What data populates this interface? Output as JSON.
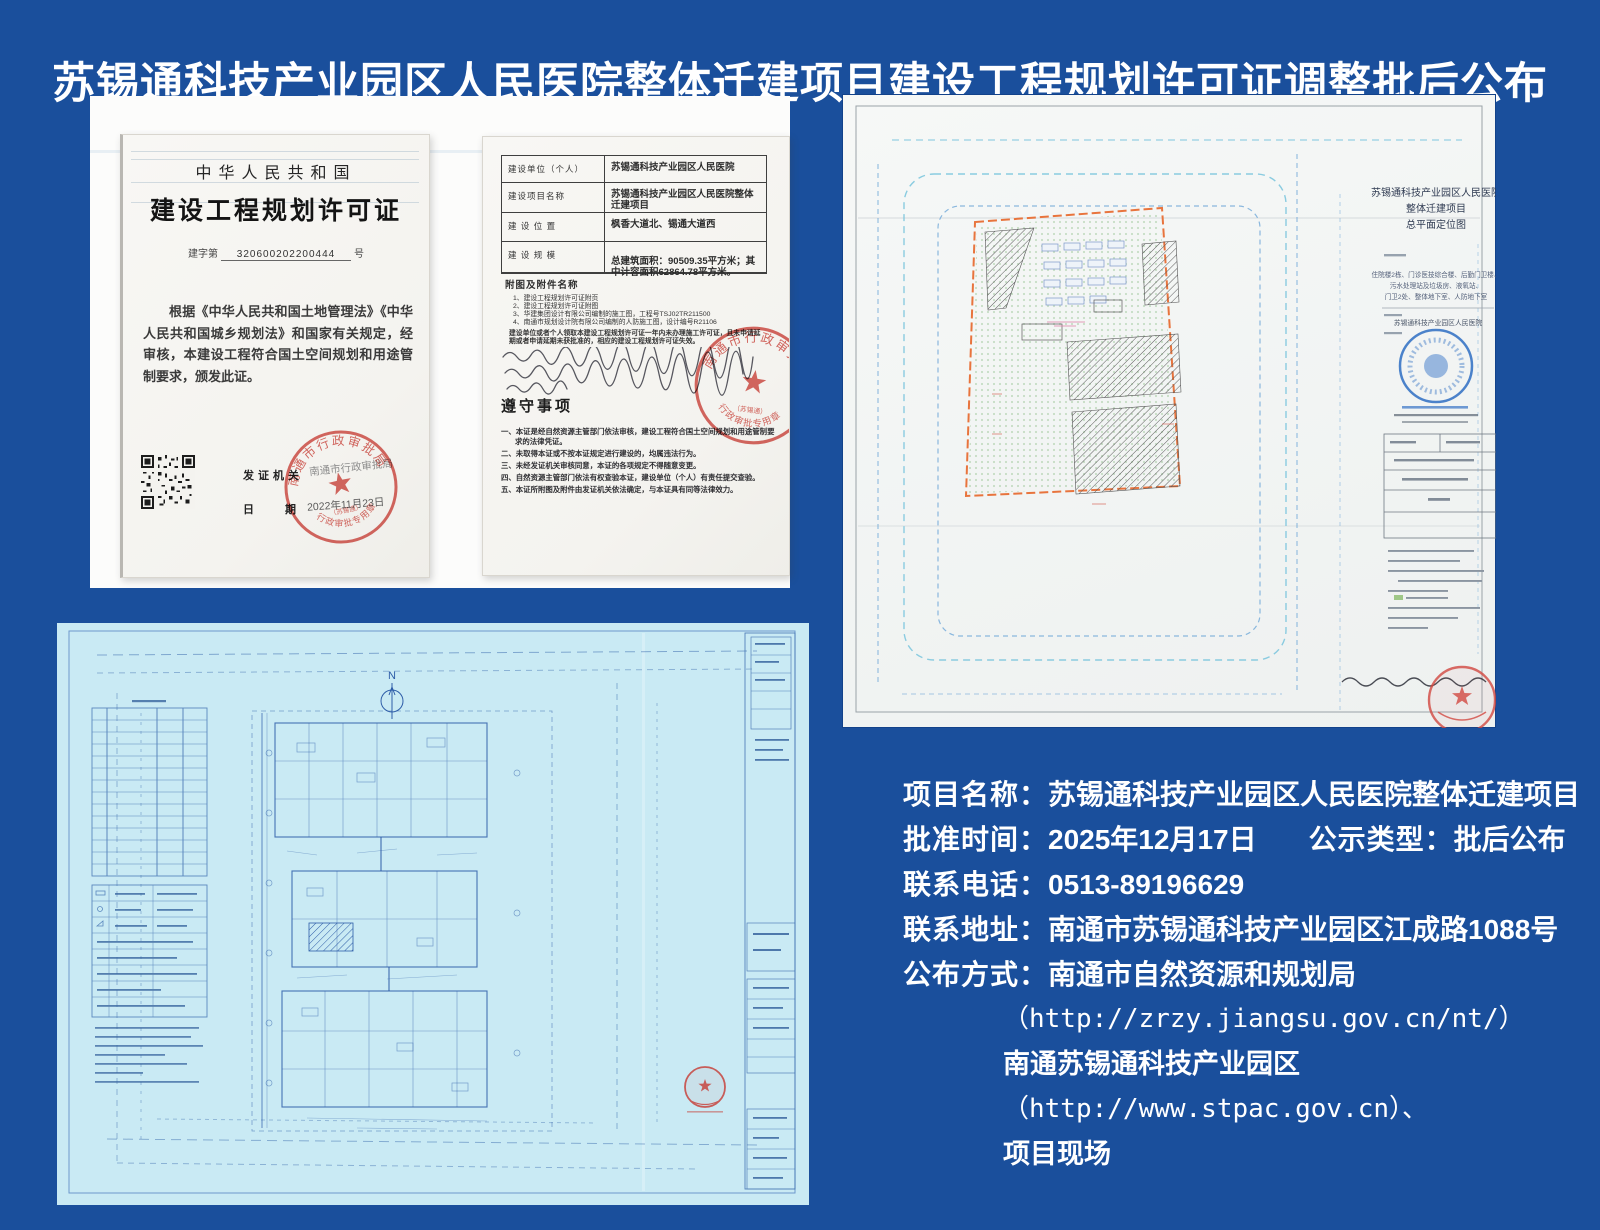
{
  "page": {
    "title": "苏锡通科技产业园区人民医院整体迁建项目建设工程规划许可证调整批后公布"
  },
  "colors": {
    "background_blue": "#1a4f9c",
    "blueprint_cyan": "#c9eaf4",
    "blueprint_ink": "#2e5da8",
    "seal_red": "#d24840",
    "review_stamp_blue": "#2f6fc4",
    "boundary_orange": "#e8743d"
  },
  "icons": {
    "qr_code": "qr-grid-shape",
    "official_seal": "red-circle-star-stamp",
    "review_stamp": "blue-circle-stamp",
    "north_arrow": "N-over-circle"
  },
  "certificate": {
    "country": "中华人民共和国",
    "title": "建设工程规划许可证",
    "number_prefix": "建字第",
    "number": "320600202200444",
    "number_suffix": "号",
    "body": "根据《中华人民共和国土地管理法》《中华人民共和国城乡规划法》和国家有关规定，经审核，本建设工程符合国土空间规划和用途管制要求，颁发此证。",
    "issuer_label": "发证机关",
    "issuer": "南通市行政审批局",
    "date_label": "日　　期",
    "date": "2022年11月23日",
    "seal_top": "南通市行政审批局",
    "seal_bottom": "行政审批专用章",
    "seal_sub": "（苏锡通）"
  },
  "permit_form": {
    "rows": [
      {
        "label": "建设单位（个人）",
        "value": "苏锡通科技产业园区人民医院"
      },
      {
        "label": "建设项目名称",
        "value": "苏锡通科技产业园区人民医院整体迁建项目"
      },
      {
        "label": "建 设 位 置",
        "value": "枫香大道北、锡通大道西"
      },
      {
        "label": "建 设 规 模",
        "value": "总建筑面积：90509.35平方米；其中计容面积62864.78平方米。"
      }
    ],
    "attachments_label": "附图及附件名称",
    "attachments": [
      "1、建设工程规划许可证附页",
      "2、建设工程规划许可证附图",
      "3、华建集团设计有限公司编制的施工图，工程号TSJ02TR211500",
      "4、南通市规划设计院有限公司编制的人防施工图，设计编号R21106"
    ],
    "note": "建设单位或者个人领取本建设工程规划许可证一年内未办理施工许可证，且未申请延期或者申请延期未获批准的，相应的建设工程规划许可证失效。",
    "rules_title": "遵守事项",
    "rules": [
      "一、本证是经自然资源主管部门依法审核，建设工程符合国土空间规划和用途管制要求的法律凭证。",
      "二、未取得本证或不按本证规定进行建设的，均属违法行为。",
      "三、未经发证机关审核同意，本证的各项规定不得随意变更。",
      "四、自然资源主管部门依法有权查验本证，建设单位（个人）有责任提交查验。",
      "五、本证所附图及附件由发证机关依法确定，与本证具有同等法律效力。"
    ]
  },
  "siteplan": {
    "title_lines": [
      "苏锡通科技产业园区人民医院",
      "整体迁建项目",
      "总平面定位图"
    ],
    "desc_lines": [
      "住院楼2栋、门诊医技综合楼、后勤门卫楼、",
      "污水处理站及垃圾房、液氧站、",
      "门卫2处、整体地下室、人防地下室"
    ],
    "unit": "苏锡通科技产业园区人民医院"
  },
  "blueprint": {
    "north_label": "N"
  },
  "info": {
    "rows": [
      {
        "label": "项目名称：",
        "value": "苏锡通科技产业园区人民医院整体迁建项目"
      },
      {
        "label": "批准时间：",
        "value": "2025年12月17日",
        "label2": "公示类型：",
        "value2": "批后公布"
      },
      {
        "label": "联系电话：",
        "value": "0513-89196629"
      },
      {
        "label": "联系地址：",
        "value": "南通市苏锡通科技产业园区江成路1088号"
      },
      {
        "label": "公布方式：",
        "value": "南通市自然资源和规划局"
      }
    ],
    "extra_lines": [
      "（http://zrzy.jiangsu.gov.cn/nt/）",
      "南通苏锡通科技产业园区",
      "（http://www.stpac.gov.cn）、",
      "项目现场"
    ]
  }
}
